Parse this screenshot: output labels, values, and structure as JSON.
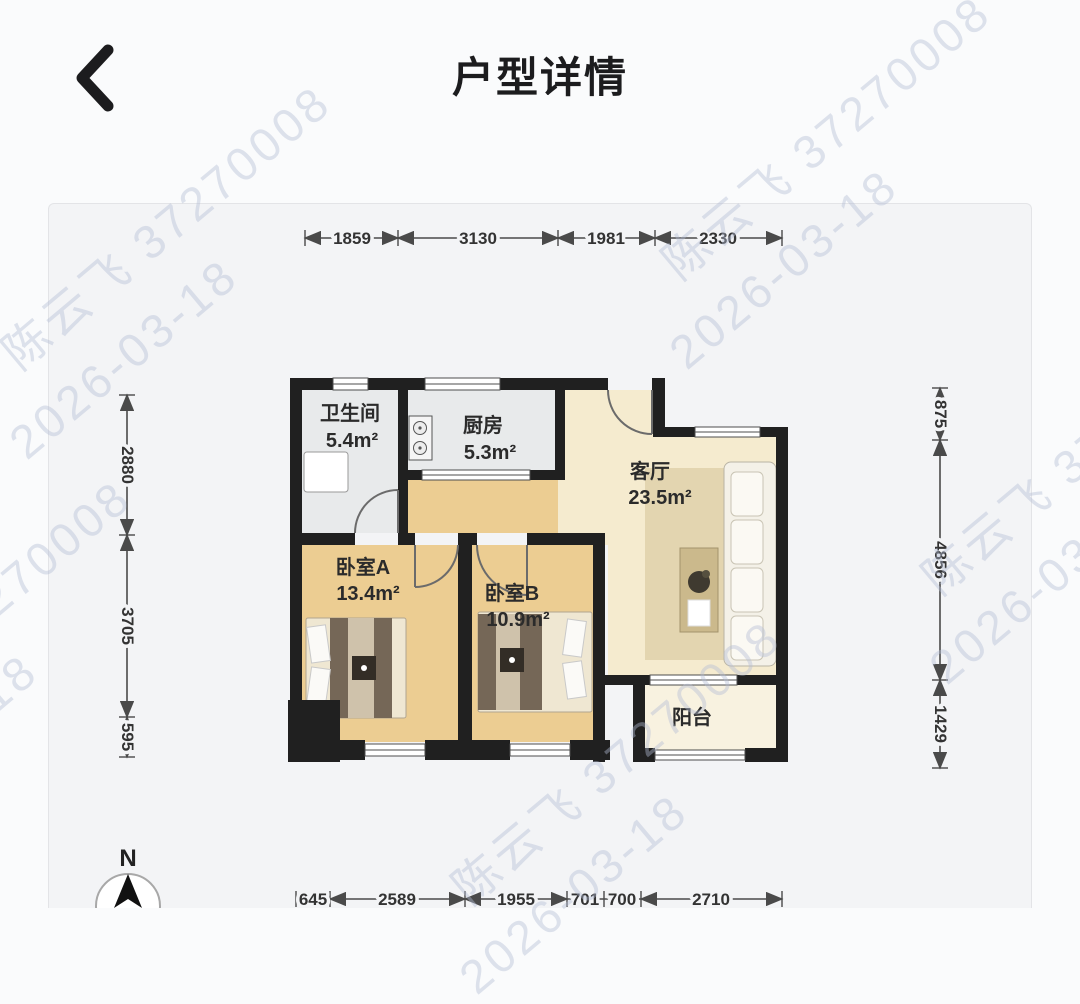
{
  "header": {
    "title": "户型详情"
  },
  "watermark": {
    "line1": "陈云飞 37270008",
    "line2": "2026-03-18"
  },
  "colors": {
    "wall": "#202020",
    "floor_wet": "#e8eaeb",
    "floor_warm": "#eccd92",
    "floor_living": "#f5ebcf",
    "floor_balcony": "#f8f2e0",
    "rug": "#d8c9a0",
    "watermark": "#b2bdd4"
  },
  "plan": {
    "rooms": [
      {
        "name": "卫生间",
        "area": "5.4m²"
      },
      {
        "name": "厨房",
        "area": "5.3m²"
      },
      {
        "name": "客厅",
        "area": "23.5m²"
      },
      {
        "name": "卧室A",
        "area": "13.4m²"
      },
      {
        "name": "卧室B",
        "area": "10.9m²"
      },
      {
        "name": "阳台",
        "area": ""
      }
    ],
    "dimensions": {
      "top": [
        "1859",
        "3130",
        "1981",
        "2330"
      ],
      "left": [
        "2880",
        "3705",
        "595"
      ],
      "right": [
        "875",
        "4856",
        "1429"
      ],
      "bottom": [
        "645",
        "2589",
        "1955",
        "701",
        "700",
        "2710"
      ]
    },
    "compass": "N"
  }
}
